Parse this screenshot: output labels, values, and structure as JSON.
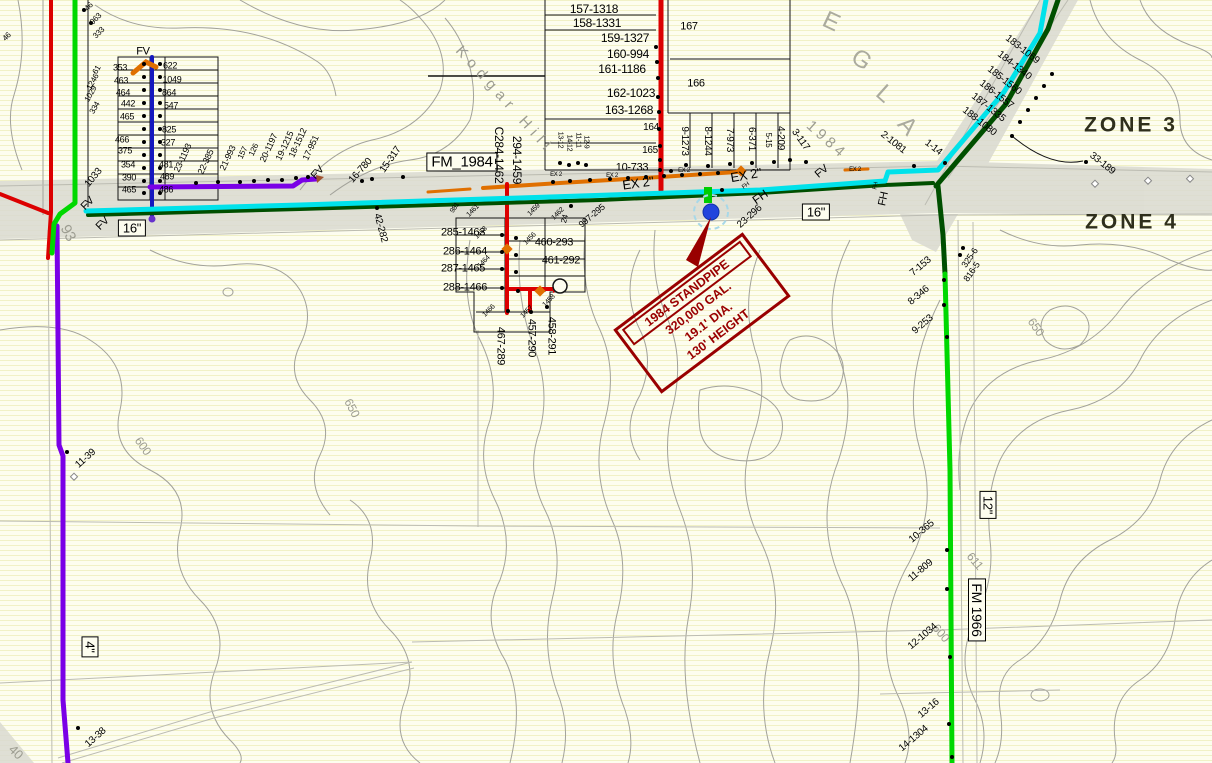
{
  "map": {
    "colors": {
      "red_main": "#DC0000",
      "dark_red": "#990000",
      "bright_green": "#00D800",
      "dark_green": "#004F00",
      "cyan": "#00E2EA",
      "purple": "#7A00E6",
      "blue": "#1518BE",
      "orange": "#E07000",
      "road_gray": "#D9D9D0",
      "contour_gray": "#A2A29A",
      "hatch": "#F1F1C6",
      "base": "#FDFDEF"
    },
    "zones": [
      {
        "label": "ZONE 3"
      },
      {
        "label": "ZONE 4"
      }
    ],
    "standpipe": {
      "lines": [
        "1984 STANDPIPE",
        "320,000 GAL.",
        "19.1' DIA.",
        "130' HEIGHT"
      ]
    },
    "labels": [
      {
        "t": "FM_1984",
        "x": 462,
        "y": 162,
        "cls": "roadbox",
        "s": 15
      },
      {
        "t": "16\"",
        "x": 132,
        "y": 228,
        "cls": "roadbox"
      },
      {
        "t": "16\"",
        "x": 816,
        "y": 212,
        "cls": "roadbox"
      },
      {
        "t": "12\"",
        "x": 988,
        "y": 505,
        "r": 90,
        "cls": "roadbox"
      },
      {
        "t": "FM 1966",
        "x": 977,
        "y": 610,
        "r": 90,
        "cls": "roadbox",
        "s": 14
      },
      {
        "t": "4\"",
        "x": 90,
        "y": 647,
        "r": 90,
        "cls": "roadbox"
      },
      {
        "t": "Kodgar Hill",
        "x": 505,
        "y": 100,
        "r": 48,
        "cls": "street",
        "ls": 6
      },
      {
        "t": "1984",
        "x": 827,
        "y": 140,
        "r": 42,
        "cls": "street",
        "ls": 4
      },
      {
        "t": "E",
        "x": 831,
        "y": 22,
        "r": 25,
        "cls": "bigletter"
      },
      {
        "t": "G",
        "x": 861,
        "y": 60,
        "r": 35,
        "cls": "bigletter"
      },
      {
        "t": "L",
        "x": 884,
        "y": 94,
        "r": 42,
        "cls": "bigletter"
      },
      {
        "t": "A",
        "x": 907,
        "y": 126,
        "r": 48,
        "cls": "bigletter"
      },
      {
        "t": "650",
        "x": 352,
        "y": 408,
        "r": 62,
        "cls": "contour"
      },
      {
        "t": "650",
        "x": 1036,
        "y": 327,
        "r": 55,
        "cls": "contour"
      },
      {
        "t": "600",
        "x": 143,
        "y": 446,
        "r": 55,
        "cls": "contour"
      },
      {
        "t": "611",
        "x": 975,
        "y": 561,
        "r": 50,
        "cls": "contour"
      },
      {
        "t": "600",
        "x": 941,
        "y": 633,
        "r": 50,
        "cls": "contour"
      },
      {
        "t": "93",
        "x": 68,
        "y": 233,
        "r": 62,
        "s": 15,
        "cls": "contour"
      },
      {
        "t": "40",
        "x": 16,
        "y": 752,
        "r": 45,
        "s": 13,
        "cls": "contour"
      },
      {
        "t": "EX 2\"",
        "x": 638,
        "y": 183,
        "r": -8,
        "s": 13,
        "cls": "ex"
      },
      {
        "t": "EX 2\"",
        "x": 746,
        "y": 175,
        "r": -10,
        "s": 13,
        "cls": "ex"
      },
      {
        "t": "EX 2",
        "x": 612,
        "y": 176,
        "s": 6,
        "cls": "ex"
      },
      {
        "t": "EX 2",
        "x": 684,
        "y": 171,
        "s": 6,
        "cls": "ex"
      },
      {
        "t": "EX 2",
        "x": 556,
        "y": 175,
        "s": 6,
        "cls": "ex"
      },
      {
        "t": "EX 2",
        "x": 855,
        "y": 170,
        "s": 6,
        "cls": "ex"
      },
      {
        "t": "FV",
        "x": 143,
        "y": 52,
        "s": 11
      },
      {
        "t": "FV",
        "x": 88,
        "y": 204,
        "r": -45,
        "s": 11
      },
      {
        "t": "FV",
        "x": 103,
        "y": 224,
        "r": -45,
        "s": 11
      },
      {
        "t": "FV",
        "x": 318,
        "y": 173,
        "r": -48,
        "s": 11
      },
      {
        "t": "FV",
        "x": 822,
        "y": 172,
        "r": -40,
        "s": 11
      },
      {
        "t": "FH",
        "x": 760,
        "y": 197,
        "r": -35,
        "s": 12
      },
      {
        "t": "FH",
        "x": 884,
        "y": 199,
        "r": -78,
        "s": 11
      },
      {
        "t": "FH",
        "x": 746,
        "y": 186,
        "r": -35,
        "s": 6
      },
      {
        "t": "FH",
        "x": 876,
        "y": 186,
        "r": -78,
        "s": 6
      },
      {
        "t": "157-1318",
        "x": 594,
        "y": 9,
        "s": 12
      },
      {
        "t": "158-1331",
        "x": 597,
        "y": 23,
        "s": 12
      },
      {
        "t": "159-1327",
        "x": 625,
        "y": 38,
        "s": 12
      },
      {
        "t": "160-994",
        "x": 628,
        "y": 54,
        "s": 12
      },
      {
        "t": "161-1186",
        "x": 622,
        "y": 69,
        "s": 12
      },
      {
        "t": "162-1023",
        "x": 631,
        "y": 93,
        "s": 12
      },
      {
        "t": "163-1268",
        "x": 629,
        "y": 110,
        "s": 12
      },
      {
        "t": "10-733",
        "x": 632,
        "y": 168,
        "s": 11
      },
      {
        "t": "167",
        "x": 689,
        "y": 27,
        "s": 11
      },
      {
        "t": "166",
        "x": 696,
        "y": 84,
        "s": 11
      },
      {
        "t": "164",
        "x": 651,
        "y": 128
      },
      {
        "t": "165",
        "x": 650,
        "y": 151
      },
      {
        "t": "9-1273",
        "x": 684,
        "y": 141,
        "r": 90
      },
      {
        "t": "8-1244",
        "x": 707,
        "y": 141,
        "r": 90
      },
      {
        "t": "7-973",
        "x": 729,
        "y": 140,
        "r": 90
      },
      {
        "t": "6-371",
        "x": 751,
        "y": 139,
        "r": 90
      },
      {
        "t": "5-15",
        "x": 768,
        "y": 140,
        "r": 90,
        "s": 8
      },
      {
        "t": "4-209",
        "x": 780,
        "y": 138,
        "r": 90
      },
      {
        "t": "3-117",
        "x": 800,
        "y": 140,
        "r": 55
      },
      {
        "t": "2-1081",
        "x": 893,
        "y": 143,
        "r": 38
      },
      {
        "t": "1-14",
        "x": 933,
        "y": 148,
        "r": 38
      },
      {
        "t": "183-1069",
        "x": 1022,
        "y": 50,
        "r": 38
      },
      {
        "t": "184-1340",
        "x": 1014,
        "y": 66,
        "r": 38
      },
      {
        "t": "185-1560",
        "x": 1004,
        "y": 81,
        "r": 38
      },
      {
        "t": "186-1557",
        "x": 996,
        "y": 95,
        "r": 38
      },
      {
        "t": "187-1335",
        "x": 988,
        "y": 108,
        "r": 38
      },
      {
        "t": "188-1080",
        "x": 979,
        "y": 122,
        "r": 38
      },
      {
        "t": "33-189",
        "x": 1102,
        "y": 164,
        "r": 38
      },
      {
        "t": "7-153",
        "x": 921,
        "y": 267,
        "r": -40
      },
      {
        "t": "8-346",
        "x": 919,
        "y": 296,
        "r": -40
      },
      {
        "t": "9-253",
        "x": 923,
        "y": 325,
        "r": -40
      },
      {
        "t": "325-6",
        "x": 970,
        "y": 258,
        "r": -55,
        "s": 9
      },
      {
        "t": "816-5",
        "x": 972,
        "y": 272,
        "r": -55,
        "s": 9
      },
      {
        "t": "10-365",
        "x": 922,
        "y": 532,
        "r": -40
      },
      {
        "t": "11-809",
        "x": 921,
        "y": 571,
        "r": -40
      },
      {
        "t": "12-1034",
        "x": 923,
        "y": 637,
        "r": -40
      },
      {
        "t": "13-16",
        "x": 929,
        "y": 709,
        "r": -40
      },
      {
        "t": "14-1304",
        "x": 914,
        "y": 739,
        "r": -40
      },
      {
        "t": "11-39",
        "x": 86,
        "y": 459,
        "r": -42
      },
      {
        "t": "13-38",
        "x": 96,
        "y": 738,
        "r": -42
      },
      {
        "t": "353",
        "x": 120,
        "y": 68,
        "s": 9
      },
      {
        "t": "463",
        "x": 121,
        "y": 81,
        "s": 9
      },
      {
        "t": "464",
        "x": 123,
        "y": 93,
        "s": 9
      },
      {
        "t": "442",
        "x": 128,
        "y": 104,
        "s": 9
      },
      {
        "t": "465",
        "x": 127,
        "y": 117,
        "s": 9
      },
      {
        "t": "466",
        "x": 122,
        "y": 140,
        "s": 9
      },
      {
        "t": "375",
        "x": 125,
        "y": 151,
        "s": 9
      },
      {
        "t": "354",
        "x": 128,
        "y": 165,
        "s": 9
      },
      {
        "t": "390",
        "x": 129,
        "y": 178,
        "s": 9
      },
      {
        "t": "465",
        "x": 129,
        "y": 190,
        "s": 9
      },
      {
        "t": "622",
        "x": 170,
        "y": 66,
        "s": 9
      },
      {
        "t": "1049",
        "x": 172,
        "y": 80,
        "s": 9
      },
      {
        "t": "864",
        "x": 169,
        "y": 93,
        "s": 9
      },
      {
        "t": "547",
        "x": 171,
        "y": 106,
        "s": 9
      },
      {
        "t": "825",
        "x": 169,
        "y": 130,
        "s": 9
      },
      {
        "t": "327",
        "x": 168,
        "y": 143,
        "s": 9
      },
      {
        "t": "481",
        "x": 166,
        "y": 165,
        "s": 9
      },
      {
        "t": "489",
        "x": 167,
        "y": 177,
        "s": 9
      },
      {
        "t": "486",
        "x": 166,
        "y": 190,
        "s": 9
      },
      {
        "t": "61",
        "x": 97,
        "y": 70,
        "r": -60,
        "s": 8
      },
      {
        "t": "1246",
        "x": 93,
        "y": 82,
        "r": -60,
        "s": 8
      },
      {
        "t": "1029",
        "x": 91,
        "y": 94,
        "r": -60,
        "s": 8
      },
      {
        "t": "334",
        "x": 95,
        "y": 108,
        "r": -60,
        "s": 8
      },
      {
        "t": "1033",
        "x": 94,
        "y": 178,
        "r": -50
      },
      {
        "t": "46",
        "x": 89,
        "y": 7,
        "r": -45,
        "s": 8
      },
      {
        "t": "963",
        "x": 96,
        "y": 19,
        "r": -45,
        "s": 8
      },
      {
        "t": "333",
        "x": 99,
        "y": 33,
        "r": -45,
        "s": 8
      },
      {
        "t": "46",
        "x": 7,
        "y": 37,
        "r": -45,
        "s": 8
      },
      {
        "t": "23-1193",
        "x": 183,
        "y": 158,
        "r": -65,
        "s": 9
      },
      {
        "t": "22-385",
        "x": 206,
        "y": 162,
        "r": -65,
        "s": 9
      },
      {
        "t": "21-993",
        "x": 228,
        "y": 158,
        "r": -65,
        "s": 9
      },
      {
        "t": "157",
        "x": 243,
        "y": 153,
        "r": -65,
        "s": 8
      },
      {
        "t": "126",
        "x": 254,
        "y": 150,
        "r": -65,
        "s": 8
      },
      {
        "t": "20-1197",
        "x": 269,
        "y": 148,
        "r": -65,
        "s": 9
      },
      {
        "t": "19-1215",
        "x": 285,
        "y": 146,
        "r": -65,
        "s": 9
      },
      {
        "t": "18-1512",
        "x": 298,
        "y": 143,
        "r": -65,
        "s": 9
      },
      {
        "t": "17-951",
        "x": 311,
        "y": 148,
        "r": -65,
        "s": 9
      },
      {
        "t": "15-317",
        "x": 391,
        "y": 160,
        "r": -55
      },
      {
        "t": "16-780",
        "x": 361,
        "y": 171,
        "r": -48
      },
      {
        "t": "42-282",
        "x": 380,
        "y": 228,
        "r": 75
      },
      {
        "t": "C284-1462",
        "x": 499,
        "y": 155,
        "r": 90,
        "s": 12
      },
      {
        "t": "294-1459",
        "x": 517,
        "y": 160,
        "r": 90,
        "s": 12
      },
      {
        "t": "285-1463",
        "x": 463,
        "y": 233,
        "s": 11
      },
      {
        "t": "286-1464",
        "x": 465,
        "y": 252,
        "s": 11
      },
      {
        "t": "287-1465",
        "x": 463,
        "y": 269,
        "s": 11
      },
      {
        "t": "288-1466",
        "x": 465,
        "y": 288,
        "s": 11
      },
      {
        "t": "460-293",
        "x": 554,
        "y": 243,
        "s": 11
      },
      {
        "t": "461-292",
        "x": 561,
        "y": 261,
        "s": 11
      },
      {
        "t": "467-289",
        "x": 500,
        "y": 346,
        "r": 90,
        "s": 11
      },
      {
        "t": "457-290",
        "x": 531,
        "y": 338,
        "r": 90,
        "s": 11
      },
      {
        "t": "458-291",
        "x": 551,
        "y": 336,
        "r": 90,
        "s": 11
      },
      {
        "t": "1461",
        "x": 473,
        "y": 211,
        "r": -45,
        "s": 7
      },
      {
        "t": "981",
        "x": 455,
        "y": 208,
        "r": -55,
        "s": 7
      },
      {
        "t": "1459",
        "x": 534,
        "y": 210,
        "r": -45,
        "s": 7
      },
      {
        "t": "1462",
        "x": 558,
        "y": 214,
        "r": -45,
        "s": 7
      },
      {
        "t": "997-295",
        "x": 592,
        "y": 216,
        "r": -40,
        "s": 9
      },
      {
        "t": "24",
        "x": 565,
        "y": 219,
        "r": -75,
        "s": 8
      },
      {
        "t": "1463",
        "x": 481,
        "y": 233,
        "r": -45,
        "s": 7
      },
      {
        "t": "1464",
        "x": 484,
        "y": 262,
        "r": -45,
        "s": 7
      },
      {
        "t": "1456",
        "x": 530,
        "y": 239,
        "r": -45,
        "s": 7
      },
      {
        "t": "1458",
        "x": 549,
        "y": 301,
        "r": -45,
        "s": 7
      },
      {
        "t": "1457",
        "x": 527,
        "y": 312,
        "r": -45,
        "s": 7
      },
      {
        "t": "1466",
        "x": 489,
        "y": 311,
        "r": -45,
        "s": 7
      },
      {
        "t": "23-296",
        "x": 750,
        "y": 217,
        "r": -42
      },
      {
        "t": "13-12",
        "x": 560,
        "y": 140,
        "r": 90,
        "s": 7
      },
      {
        "t": "14-12",
        "x": 569,
        "y": 143,
        "r": 90,
        "s": 7
      },
      {
        "t": "11-11",
        "x": 578,
        "y": 140,
        "r": 90,
        "s": 7
      },
      {
        "t": "12-9",
        "x": 586,
        "y": 142,
        "r": 90,
        "s": 7
      }
    ],
    "dots": [
      [
        144,
        64
      ],
      [
        160,
        64
      ],
      [
        144,
        77
      ],
      [
        160,
        77
      ],
      [
        144,
        90
      ],
      [
        160,
        90
      ],
      [
        144,
        103
      ],
      [
        160,
        103
      ],
      [
        144,
        116
      ],
      [
        160,
        116
      ],
      [
        144,
        129
      ],
      [
        160,
        129
      ],
      [
        144,
        142
      ],
      [
        160,
        142
      ],
      [
        144,
        155
      ],
      [
        160,
        155
      ],
      [
        144,
        168
      ],
      [
        160,
        168
      ],
      [
        144,
        181
      ],
      [
        160,
        181
      ],
      [
        144,
        193
      ],
      [
        160,
        193
      ],
      [
        656,
        47
      ],
      [
        657,
        62
      ],
      [
        658,
        78
      ],
      [
        658,
        97
      ],
      [
        659,
        112
      ],
      [
        659,
        129
      ],
      [
        660,
        146
      ],
      [
        660,
        160
      ],
      [
        686,
        165
      ],
      [
        708,
        166
      ],
      [
        730,
        164
      ],
      [
        752,
        163
      ],
      [
        774,
        162
      ],
      [
        790,
        160
      ],
      [
        806,
        162
      ],
      [
        196,
        183
      ],
      [
        218,
        182
      ],
      [
        240,
        182
      ],
      [
        254,
        181
      ],
      [
        268,
        180
      ],
      [
        282,
        180
      ],
      [
        296,
        178
      ],
      [
        308,
        177
      ],
      [
        1052,
        74
      ],
      [
        1044,
        86
      ],
      [
        1036,
        98
      ],
      [
        1028,
        110
      ],
      [
        1020,
        122
      ],
      [
        1012,
        136
      ],
      [
        914,
        166
      ],
      [
        945,
        163
      ],
      [
        1086,
        162
      ],
      [
        944,
        280
      ],
      [
        944,
        305
      ],
      [
        947,
        337
      ],
      [
        963,
        248
      ],
      [
        960,
        255
      ],
      [
        947,
        550
      ],
      [
        947,
        589
      ],
      [
        950,
        657
      ],
      [
        949,
        724
      ],
      [
        952,
        757
      ],
      [
        67,
        452
      ],
      [
        78,
        728
      ],
      [
        502,
        235
      ],
      [
        516,
        238
      ],
      [
        502,
        252
      ],
      [
        516,
        255
      ],
      [
        502,
        269
      ],
      [
        516,
        272
      ],
      [
        502,
        288
      ],
      [
        518,
        291
      ],
      [
        508,
        311
      ],
      [
        531,
        312
      ],
      [
        547,
        307
      ],
      [
        553,
        182
      ],
      [
        570,
        181
      ],
      [
        590,
        180
      ],
      [
        610,
        179
      ],
      [
        628,
        178
      ],
      [
        646,
        177
      ],
      [
        664,
        176
      ],
      [
        682,
        175
      ],
      [
        700,
        174
      ],
      [
        718,
        173
      ],
      [
        660,
        170
      ],
      [
        671,
        171
      ],
      [
        403,
        177
      ],
      [
        372,
        179
      ],
      [
        362,
        181
      ],
      [
        377,
        208
      ],
      [
        560,
        163
      ],
      [
        569,
        165
      ],
      [
        578,
        163
      ],
      [
        586,
        165
      ],
      [
        84,
        10
      ],
      [
        91,
        23
      ],
      [
        571,
        206
      ],
      [
        722,
        190
      ]
    ]
  }
}
